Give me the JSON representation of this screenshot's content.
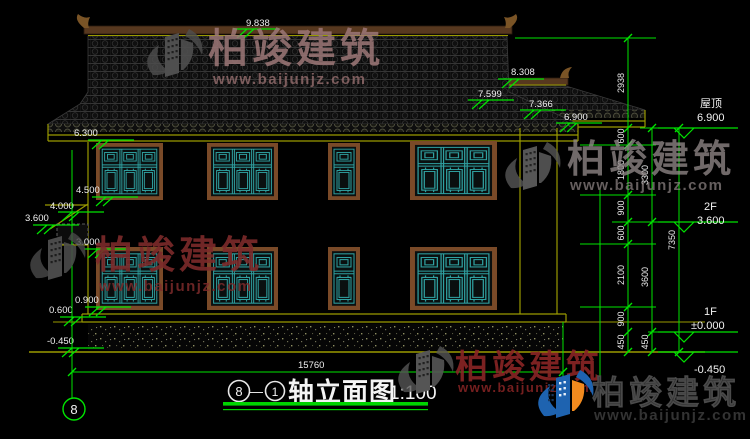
{
  "levels": {
    "v9838": "9.838",
    "v8308": "8.308",
    "v7599": "7.599",
    "v7366": "7.366",
    "v6900": "6.900",
    "v6300": "6.300",
    "v4500": "4.500",
    "v4000": "4.000",
    "v3600": "3.600",
    "v3000": "3.000",
    "v0900": "0.900",
    "v0600": "0.600",
    "vn0450": "-0.450"
  },
  "floor_labels": {
    "roof": "屋顶",
    "roof_level": "6.900",
    "f2": "2F",
    "f2_level": "3.600",
    "f1": "1F",
    "f1_level": "±0.000",
    "ground_level": "-0.450"
  },
  "dims": {
    "total": "15760",
    "chain_a": [
      "2938",
      "600",
      "1800",
      "900",
      "600",
      "2100",
      "900",
      "450"
    ],
    "chain_b": [
      "3300",
      "3600",
      "450"
    ],
    "chain_c": [
      "7350"
    ]
  },
  "title_block": {
    "bubble_left": "8",
    "dash": "—",
    "bubble_right": "1",
    "name": "轴立面图",
    "scale": "1:100"
  },
  "axis_bubble": "8",
  "watermark": {
    "name": "柏竣建筑",
    "site": "www.baijunjz.com"
  },
  "colors": {
    "dim_green": "#00e400",
    "line_olive": "#9a9a00",
    "frame_brown": "#7a4a28",
    "lattice_teal": "#2fa0a0",
    "wm_red": "#8a2525",
    "logo_blue": "#1e63b0",
    "logo_orange": "#f28a1e"
  }
}
